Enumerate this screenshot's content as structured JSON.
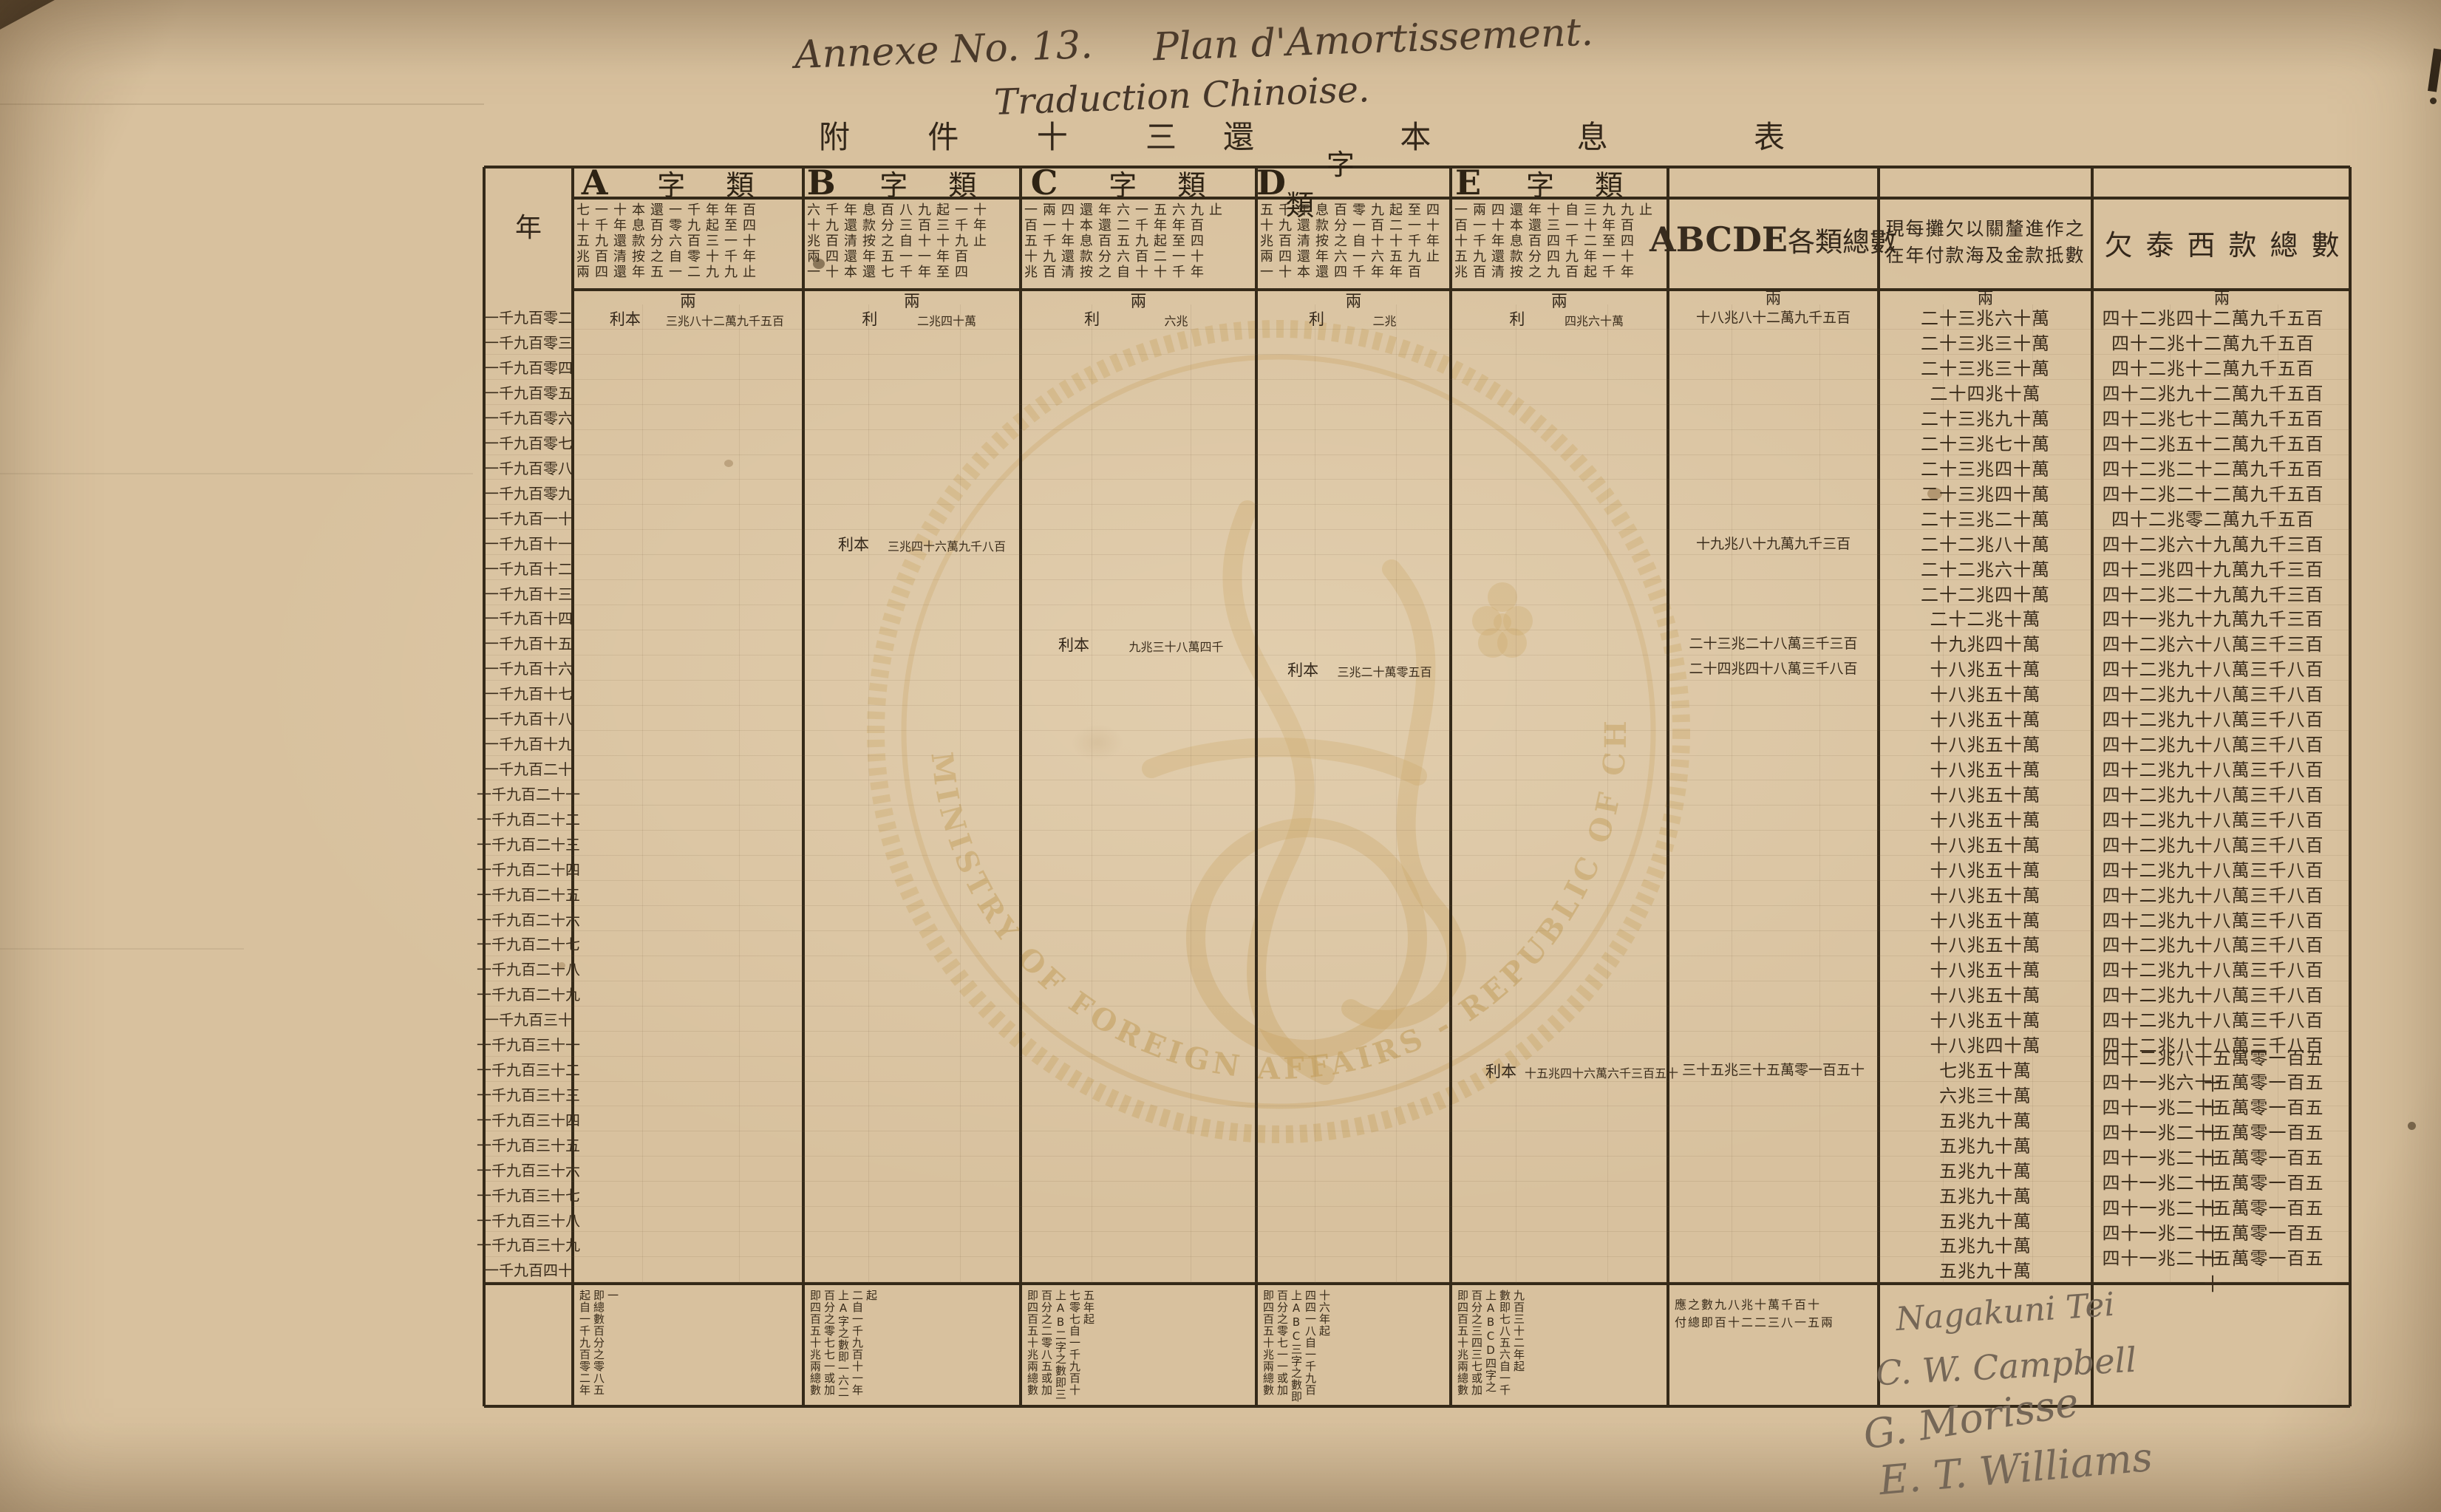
{
  "titles": {
    "annexe": "Annexe No. 13.",
    "plan": "Plan d'Amortissement.",
    "traduction": "Traduction Chinoise.",
    "chinese_left": "附 件 十 三",
    "chinese_right": "還 本 息 表"
  },
  "watermark": {
    "text": "MINISTRY OF FOREIGN AFFAIRS - REPUBLIC OF CHINA"
  },
  "table": {
    "year_header": "年",
    "unit": "兩",
    "categories": [
      {
        "letter": "A",
        "title_cn": "字類",
        "terms": "七十五兆兩一千九百四十年還清還本息款按年還百分之五一零六自一千九百零二年起三十九年至一千九百四十年止",
        "note": "起自一千九百零二年即總數百分之零八五一",
        "annotations": [
          {
            "year": "一千九百零二",
            "label": "利本",
            "value": "三兆八十二萬九千五百"
          }
        ]
      },
      {
        "letter": "B",
        "title_cn": "字類",
        "terms": "六十兆兩一千九百四十年還清還本息款按年還百分之五七八三自一千九百十一年起三十年至一千九百四十年止",
        "note": "即四百五十兆兩總數百分之零七七一或加上A字之數即一六二二自一千九百十一年起",
        "annotations": [
          {
            "year": "一千九百零二",
            "label": "利",
            "value": "二兆四十萬"
          },
          {
            "year": "一千九百十一",
            "label": "利本",
            "value": "三兆四十六萬九千八百"
          }
        ]
      },
      {
        "letter": "C",
        "title_cn": "字類",
        "terms": "一百五十兆兩一千九百四十年還清還本息款按年還百分之六二五六自一千九百十五年起二十六年至一千九百四十年止",
        "note": "即四百五十兆兩總數百分之二零八五或加上AB二字之數即三七零七自一千九百十五年起",
        "annotations": [
          {
            "year": "一千九百零二",
            "label": "利",
            "value": "六兆"
          },
          {
            "year": "一千九百十五",
            "label": "利本",
            "value": "九兆三十八萬四千"
          }
        ]
      },
      {
        "letter": "D",
        "title_cn": "字類",
        "terms": "五十兆兩一千九百四十年還清還本息款按年還百分之六四零一自一千九百十六年起二十五年至一千九百四十年止",
        "note": "即四百五十兆兩總數百分之零七一一或加上ABC三字之數即四四一八自一千九百十六年起",
        "annotations": [
          {
            "year": "一千九百零二",
            "label": "利",
            "value": "二兆"
          },
          {
            "year": "一千九百十六",
            "label": "利本",
            "value": "三兆二十萬零五百"
          }
        ]
      },
      {
        "letter": "E",
        "title_cn": "字類",
        "terms": "一百十五兆兩一千九百四十年還清還本息款按年還百分之十三四四九自一千九百三十二年起九年至一千九百四十年止",
        "note": "即四百五十兆兩總數百分之三四三七或加上ABCD四字之數即七八五六自一千九百三十二年起",
        "annotations": [
          {
            "year": "一千九百零二",
            "label": "利",
            "value": "四兆六十萬"
          },
          {
            "year": "一千九百三十二",
            "label": "利本",
            "value": "十五兆四十六萬六千三百五十"
          }
        ]
      }
    ],
    "summary_column": {
      "header_latin": "ABCDE",
      "header_cn": "各類總數",
      "values": [
        {
          "year": "一千九百零二",
          "value": "十八兆八十二萬九千五百"
        },
        {
          "year": "一千九百十一",
          "value": "十九兆八十九萬九千三百"
        },
        {
          "year": "一千九百十五",
          "value": "二十三兆二十八萬三千三百"
        },
        {
          "year": "一千九百十六",
          "value": "二十四兆四十八萬三千八百"
        },
        {
          "year": "一千九百三十二",
          "value": "三十五兆三十五萬零一百五十"
        }
      ],
      "note_line1": "應之數九八兆十萬千百十",
      "note_line2": "付總即百十二二三八一五兩"
    },
    "annual_payment_column": {
      "header_line1": "現每攤欠以關釐進作之",
      "header_line2": "在年付款海及金款抵數",
      "values": [
        "二十三兆六十萬",
        "二十三兆三十萬",
        "二十三兆三十萬",
        "二十四兆十萬",
        "二十三兆九十萬",
        "二十三兆七十萬",
        "二十三兆四十萬",
        "二十三兆四十萬",
        "二十三兆二十萬",
        "二十二兆八十萬",
        "二十二兆六十萬",
        "二十二兆四十萬",
        "二十二兆十萬",
        "十九兆四十萬",
        "十八兆五十萬",
        "十八兆五十萬",
        "十八兆五十萬",
        "十八兆五十萬",
        "十八兆五十萬",
        "十八兆五十萬",
        "十八兆五十萬",
        "十八兆五十萬",
        "十八兆五十萬",
        "十八兆五十萬",
        "十八兆五十萬",
        "十八兆五十萬",
        "十八兆五十萬",
        "十八兆五十萬",
        "十八兆五十萬",
        "十八兆四十萬",
        "七兆五十萬",
        "六兆三十萬",
        "五兆九十萬",
        "五兆九十萬",
        "五兆九十萬",
        "五兆九十萬",
        "五兆九十萬",
        "五兆九十萬",
        "五兆九十萬"
      ]
    },
    "owed_column": {
      "header": "欠泰西款總數",
      "values": [
        "四十二兆四十二萬九千五百",
        "四十二兆十二萬九千五百",
        "四十二兆十二萬九千五百",
        "四十二兆九十二萬九千五百",
        "四十二兆七十二萬九千五百",
        "四十二兆五十二萬九千五百",
        "四十二兆二十二萬九千五百",
        "四十二兆二十二萬九千五百",
        "四十二兆零二萬九千五百",
        "四十二兆六十九萬九千三百",
        "四十二兆四十九萬九千三百",
        "四十二兆二十九萬九千三百",
        "四十一兆九十九萬九千三百",
        "四十二兆六十八萬三千三百",
        "四十二兆九十八萬三千八百",
        "四十二兆九十八萬三千八百",
        "四十二兆九十八萬三千八百",
        "四十二兆九十八萬三千八百",
        "四十二兆九十八萬三千八百",
        "四十二兆九十八萬三千八百",
        "四十二兆九十八萬三千八百",
        "四十二兆九十八萬三千八百",
        "四十二兆九十八萬三千八百",
        "四十二兆九十八萬三千八百",
        "四十二兆九十八萬三千八百",
        "四十二兆九十八萬三千八百",
        "四十二兆九十八萬三千八百",
        "四十二兆九十八萬三千八百",
        "四十二兆九十八萬三千八百",
        "四十二兆八十八萬三千八百",
        "四十二兆八十五萬零一百五十",
        "四十一兆六十五萬零一百五十",
        "四十一兆二十五萬零一百五十",
        "四十一兆二十五萬零一百五十",
        "四十一兆二十五萬零一百五十",
        "四十一兆二十五萬零一百五十",
        "四十一兆二十五萬零一百五十",
        "四十一兆二十五萬零一百五十",
        "四十一兆二十五萬零一百五十"
      ]
    },
    "years": [
      "一千九百零二",
      "一千九百零三",
      "一千九百零四",
      "一千九百零五",
      "一千九百零六",
      "一千九百零七",
      "一千九百零八",
      "一千九百零九",
      "一千九百一十",
      "一千九百十一",
      "一千九百十二",
      "一千九百十三",
      "一千九百十四",
      "一千九百十五",
      "一千九百十六",
      "一千九百十七",
      "一千九百十八",
      "一千九百十九",
      "一千九百二十",
      "一千九百二十一",
      "一千九百二十二",
      "一千九百二十三",
      "一千九百二十四",
      "一千九百二十五",
      "一千九百二十六",
      "一千九百二十七",
      "一千九百二十八",
      "一千九百二十九",
      "一千九百三十",
      "一千九百三十一",
      "一千九百三十二",
      "一千九百三十三",
      "一千九百三十四",
      "一千九百三十五",
      "一千九百三十六",
      "一千九百三十七",
      "一千九百三十八",
      "一千九百三十九",
      "一千九百四十"
    ]
  },
  "signatures": [
    "Nagakuni Tei",
    "C. W. Campbell",
    "G. Morisse",
    "E. T. Williams"
  ],
  "colors": {
    "paper": "#d8c19e",
    "ink": "#33271a",
    "pencil": "#756757",
    "seal": "#c49a55"
  }
}
